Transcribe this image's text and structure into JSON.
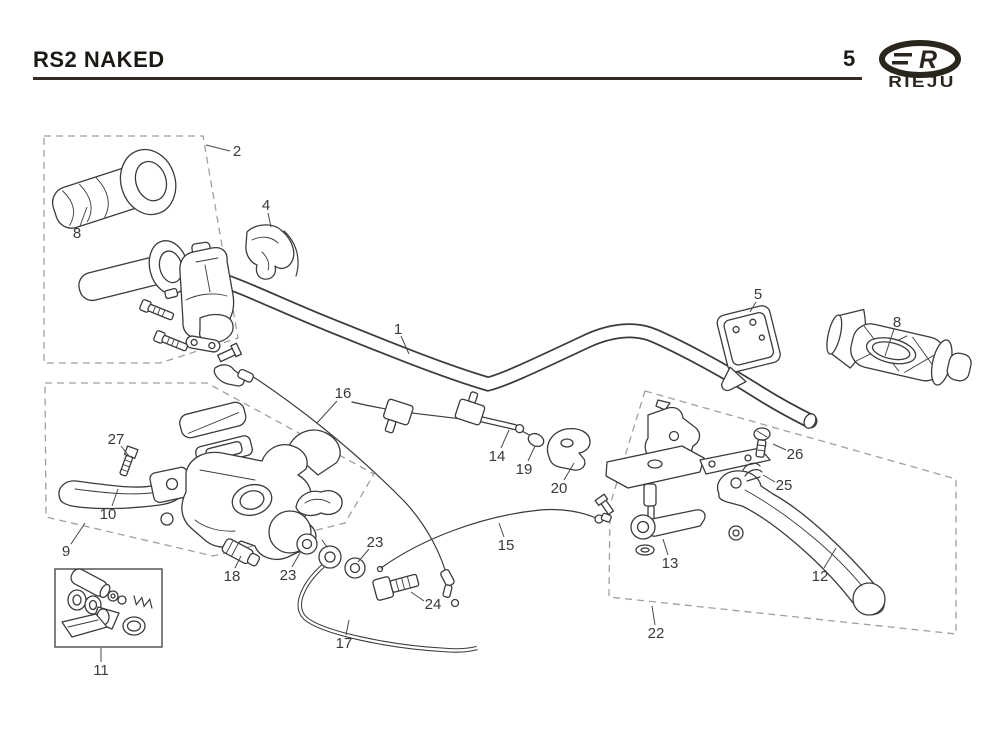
{
  "header": {
    "title": "RS2 NAKED",
    "page_number": "5",
    "brand_name": "RIEJU",
    "brand_logo_letter": "R"
  },
  "diagram": {
    "type": "exploded-parts-diagram",
    "subject": "handlebar-assembly",
    "callouts": [
      "1",
      "2",
      "4",
      "5",
      "8",
      "8",
      "9",
      "10",
      "11",
      "12",
      "13",
      "14",
      "15",
      "16",
      "17",
      "18",
      "19",
      "20",
      "22",
      "23",
      "23",
      "24",
      "25",
      "26",
      "27"
    ]
  },
  "colors": {
    "background": "#ffffff",
    "ink": "#3b3b3b",
    "dashed_box": "#9aa0a6",
    "header_ink": "#1d1a15",
    "logo": "#2b261d"
  }
}
